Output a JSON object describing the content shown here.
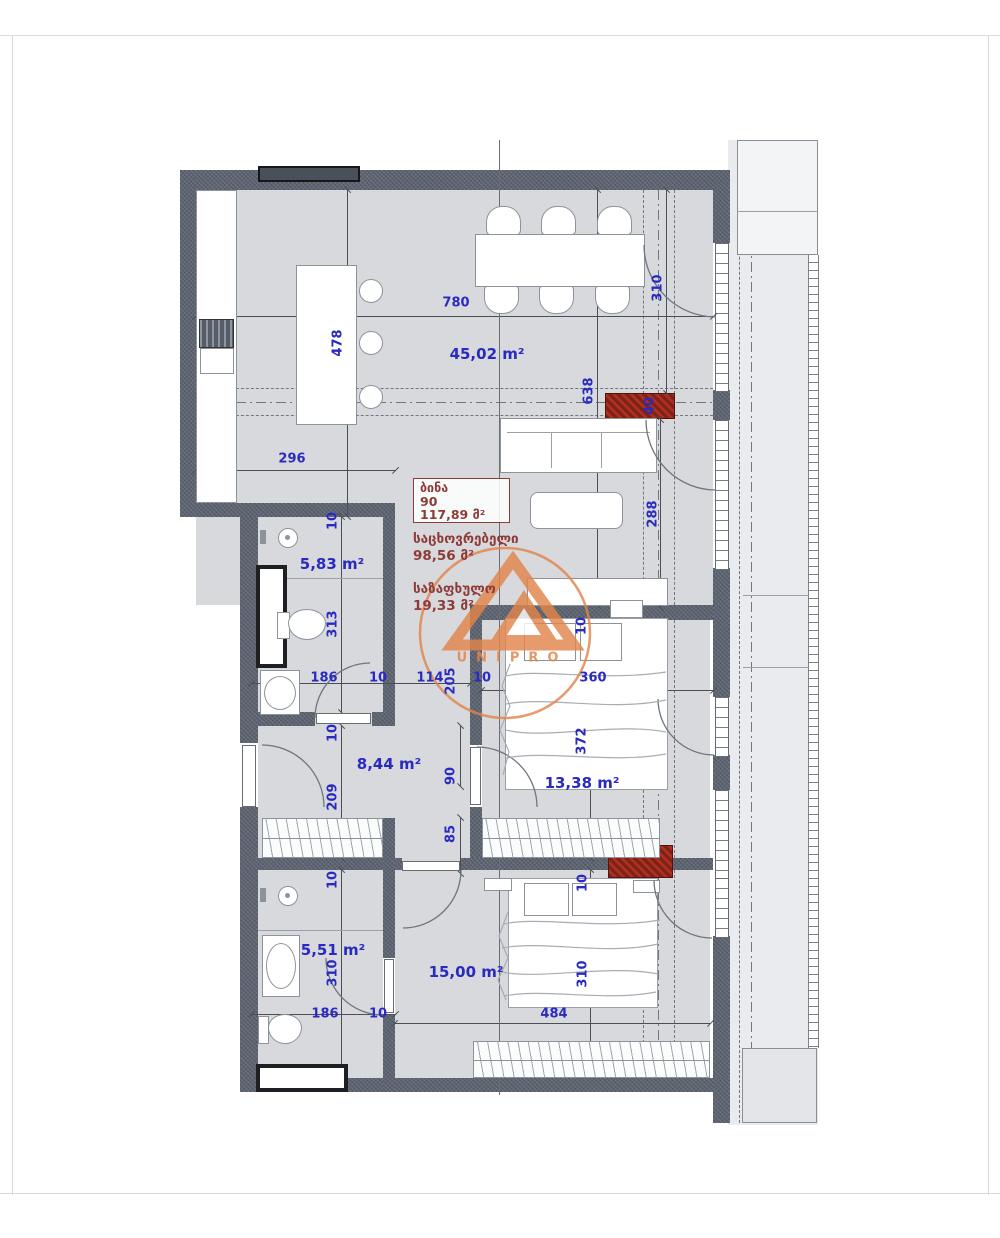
{
  "apartment_info": {
    "unit_label": "ბინა",
    "unit_number": "90",
    "total_area": "117,89 მ²",
    "living_label": "საცხოვრებელი",
    "living_area": "98,56 მ²",
    "summer_label": "საზაფხულო",
    "summer_area": "19,33 მ²"
  },
  "rooms": {
    "living_kitchen": {
      "area": "45,02 m²"
    },
    "bathroom1": {
      "area": "5,83 m²"
    },
    "hallway": {
      "area": "8,44 m²"
    },
    "bedroom1": {
      "area": "13,38 m²"
    },
    "bathroom2": {
      "area": "5,51 m²"
    },
    "bedroom2": {
      "area": "15,00 m²"
    }
  },
  "dims": {
    "d780": "780",
    "d478": "478",
    "d296": "296",
    "d310": "310",
    "d638": "638",
    "d288": "288",
    "d40": "40",
    "d10": "10",
    "d186": "186",
    "d114": "114",
    "d205": "205",
    "d313": "313",
    "d209": "209",
    "d90": "90",
    "d85": "85",
    "d360": "360",
    "d372": "372",
    "d484": "484"
  },
  "watermark": {
    "brand": "UNIPRO"
  },
  "colors": {
    "wall": "#5b6370",
    "floor": "#d7d9dc",
    "balcony_floor": "#e9ebee",
    "dimension_text": "#2a2ac0",
    "info_red": "#8e3b38",
    "shaft_red": "#ad2f1f",
    "watermark_orange": "#e2854b"
  }
}
